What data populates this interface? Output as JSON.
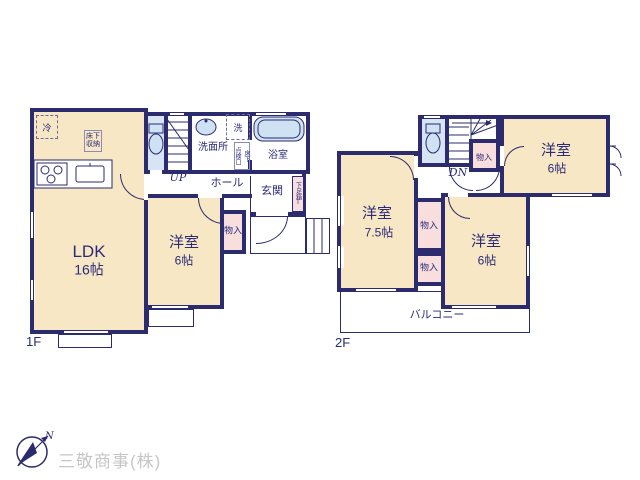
{
  "plan": {
    "f1": {
      "floor_label": "1F",
      "ldk": {
        "name": "LDK",
        "size": "16帖"
      },
      "bedroom": {
        "name": "洋室",
        "size": "6帖"
      },
      "hall": "ホール",
      "entrance": "玄関",
      "washroom": "洗面所",
      "bathroom": "浴室",
      "closet": "物入",
      "shoebox": "下足箱",
      "shoebox_t": "T",
      "fridge": "冷",
      "laundry": "洗",
      "underfloor_storage": "床下収納",
      "inspection_left": "点検口",
      "inspection_right": "床下",
      "stairs": "UP"
    },
    "f2": {
      "floor_label": "2F",
      "bedroom_a": {
        "name": "洋室",
        "size": "6帖"
      },
      "bedroom_b": {
        "name": "洋室",
        "size": "7.5帖"
      },
      "bedroom_c": {
        "name": "洋室",
        "size": "6帖"
      },
      "closets": [
        "物入",
        "物入",
        "物入"
      ],
      "balcony": "バルコニー",
      "stairs": "DN"
    }
  },
  "logo": {
    "company": "三敬商事(株)",
    "north": "N"
  },
  "colors": {
    "wall": "#2b2b6e",
    "room_fill": "#f7e7c4",
    "closet_fill": "#f9dede",
    "wet_fill": "#d6e4f4",
    "fixture_fill": "#cfe2f4",
    "text": "#2b2b7a",
    "logo_text": "#c6c6c6"
  }
}
